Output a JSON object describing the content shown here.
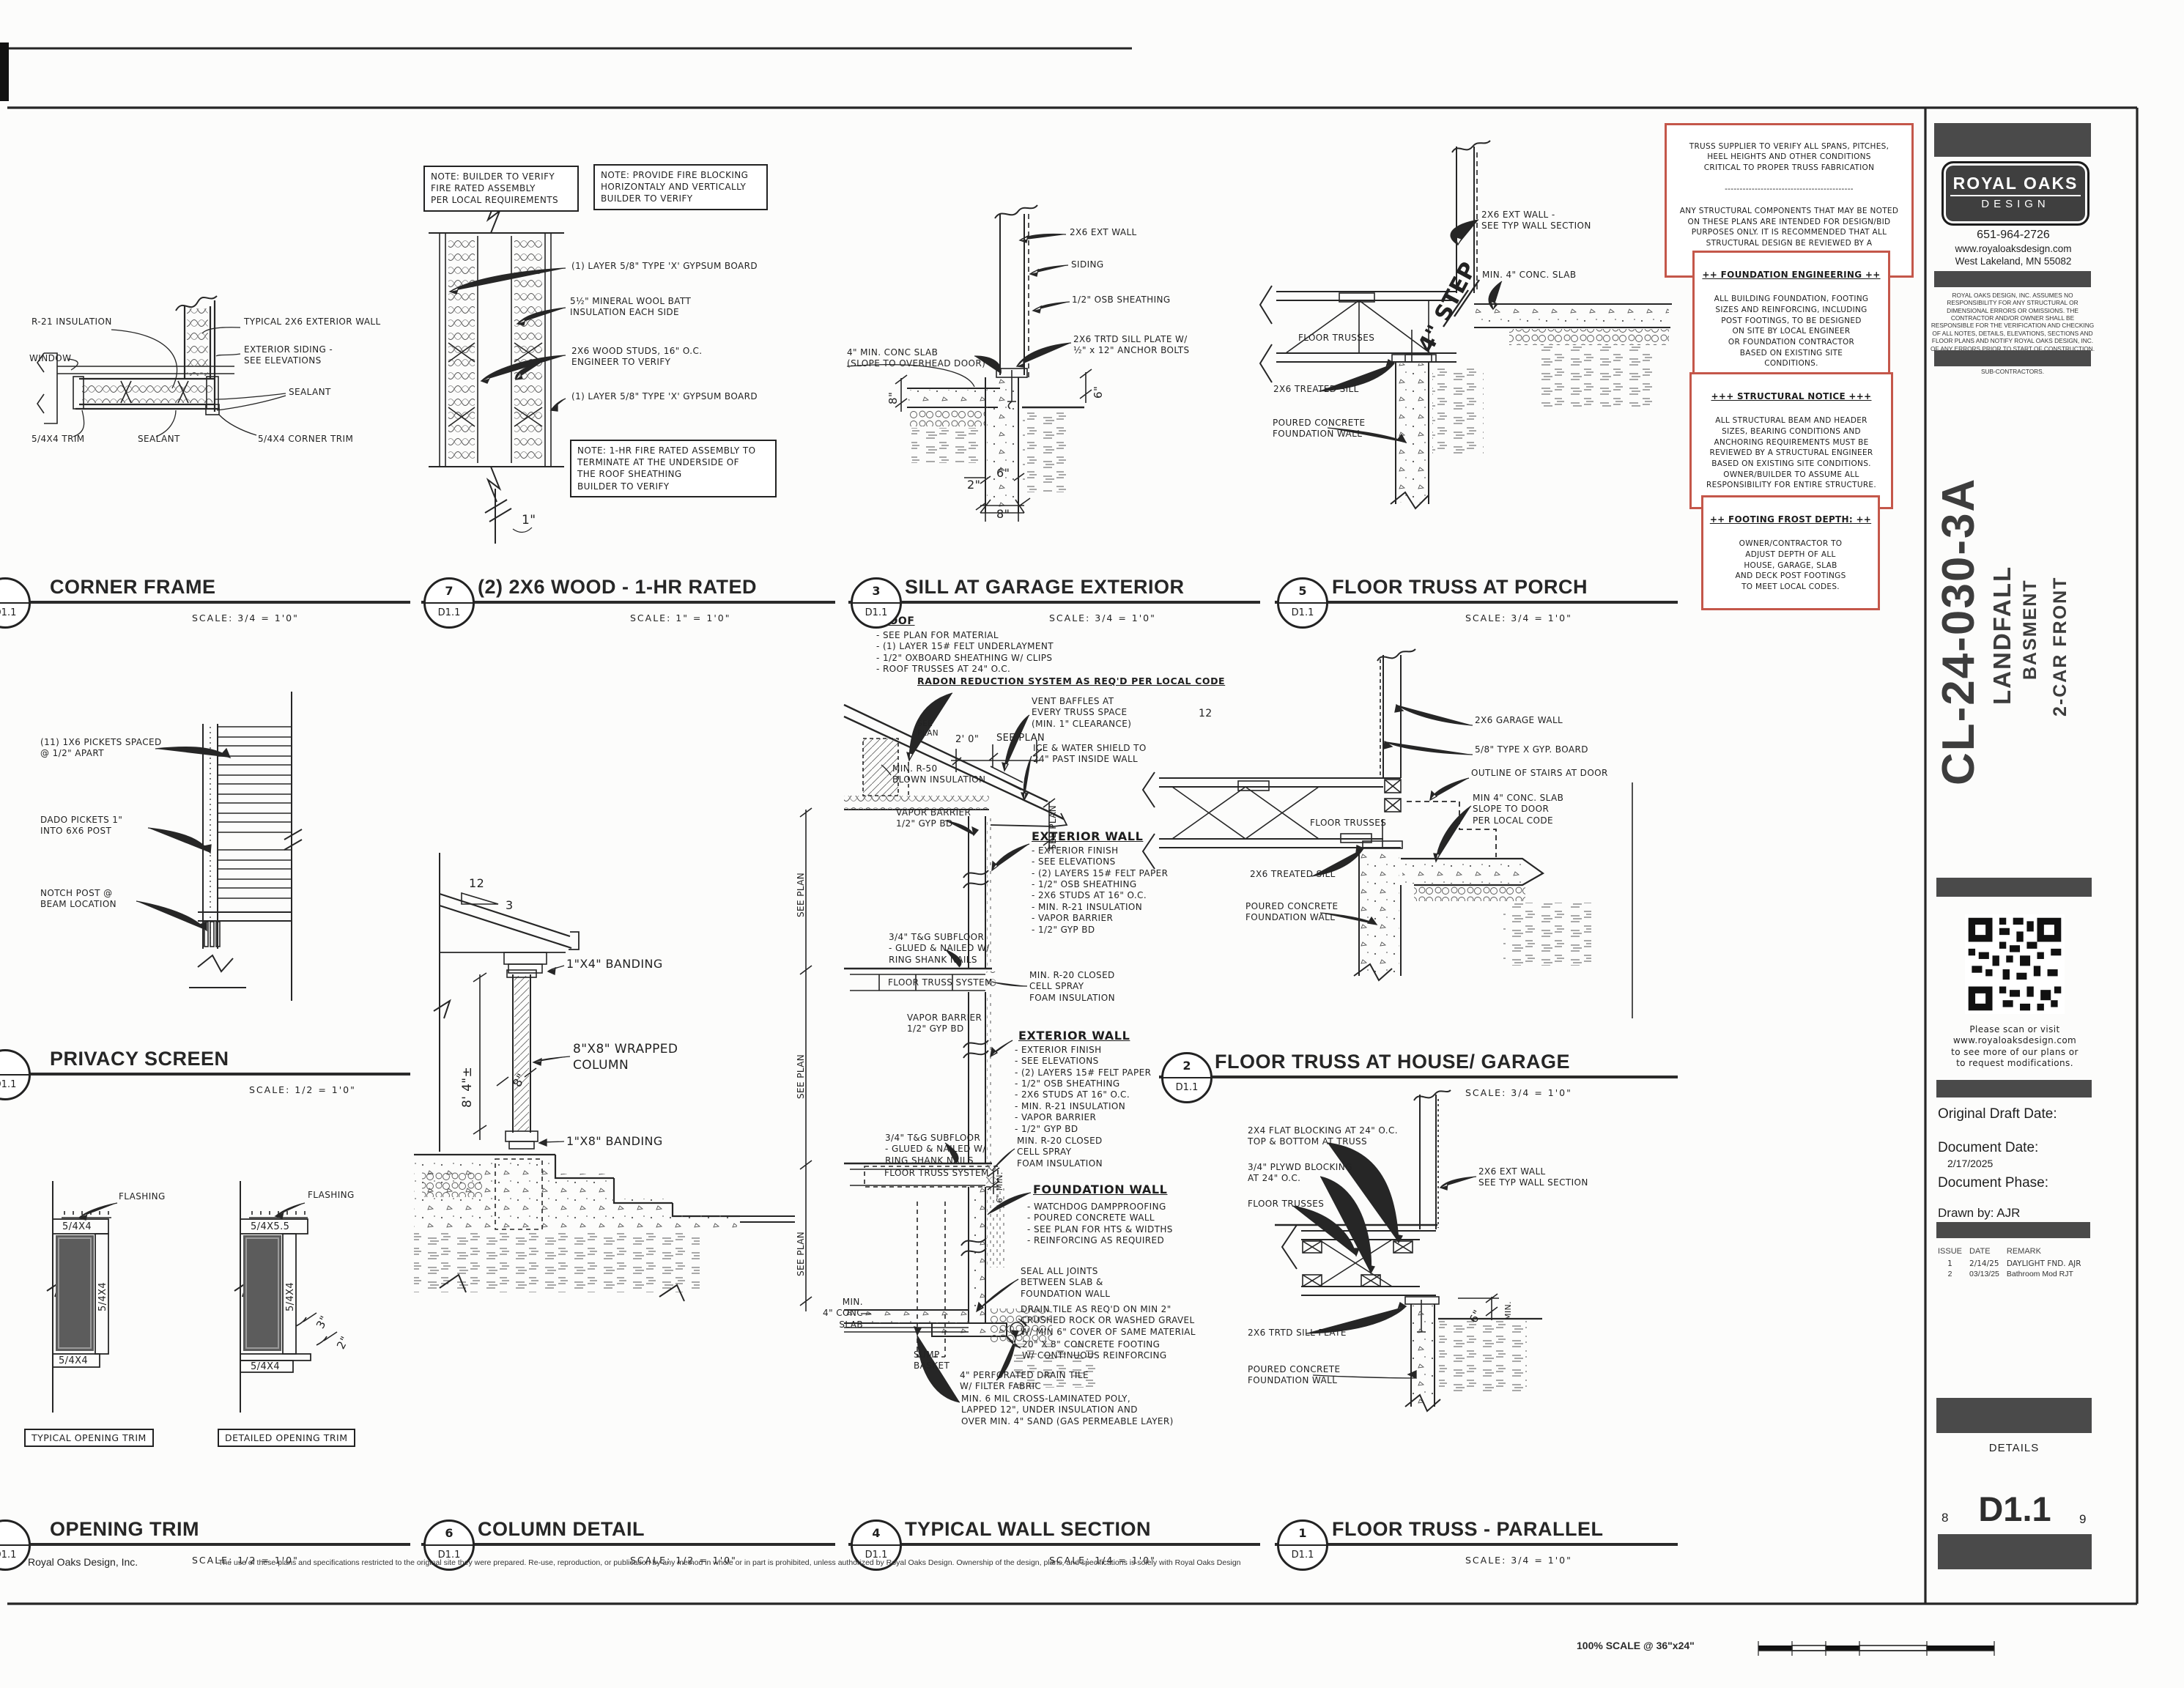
{
  "sheet": {
    "id": "CL-24-030-3A",
    "project": "LANDFALL",
    "variant": "BASMENT",
    "front": "2-CAR FRONT",
    "sheet_number": "D1.1",
    "sheet_title": "DETAILS",
    "page_left": "8",
    "page_right": "9",
    "scale_note": "100% SCALE @ 36\"x24\"",
    "firm": "Royal Oaks Design, Inc.",
    "copyright": "The use of these plans and specifications restricted to the original site they were prepared. Re-use, reproduction, or publication by any method in whole or in part is prohibited, unless authorized by Royal Oaks Design. Ownership of the design, plans, and specifications is solely with Royal Oaks Design"
  },
  "titleblock": {
    "logo_line1": "ROYAL OAKS",
    "logo_line2": "DESIGN",
    "phone": "651-964-2726",
    "website": "www.royaloaksdesign.com",
    "address": "West Lakeland, MN 55082",
    "disclaimer": "ROYAL OAKS DESIGN, INC. ASSUMES NO RESPONSIBILITY FOR ANY STRUCTURAL OR DIMENSIONAL ERRORS OR OMISSIONS. THE CONTRACTOR AND/OR OWNER SHALL BE RESPONSIBLE FOR THE VERIFICATION AND CHECKING OF ALL NOTES, DETAILS, ELEVATIONS, SECTIONS AND FLOOR PLANS AND NOTIFY ROYAL OAKS DESIGN, INC. OF ANY ERRORS PRIOR TO START OF CONSTRUCTION. ROYAL OAKS DESIGN, INC. ASSUMES NO RESPONSIBILITY FOR THE WORKMANSHIP OF THE SUB-CONTRACTORS.",
    "qr_caption": "Please scan or visit\nwww.royaloaksdesign.com\nto see more of our plans or\nto request modifications.",
    "original_draft_label": "Original Draft Date:",
    "document_date_label": "Document Date:",
    "document_date": "2/17/2025",
    "document_phase_label": "Document Phase:",
    "drawn_by": "Drawn by: AJR",
    "issue_table": {
      "headers": [
        "ISSUE",
        "DATE",
        "REMARK"
      ],
      "rows": [
        [
          "1",
          "2/14/25",
          "DAYLIGHT FND. AJR"
        ],
        [
          "2",
          "03/13/25",
          "Bathroom Mod RJT"
        ]
      ]
    }
  },
  "notices": {
    "truss_top": "TRUSS SUPPLIER TO VERIFY ALL SPANS, PITCHES,\nHEEL HEIGHTS AND OTHER CONDITIONS\nCRITICAL TO PROPER TRUSS FABRICATION",
    "truss_divider": "-------------------------------------------",
    "truss_bottom": "ANY STRUCTURAL COMPONENTS THAT MAY BE NOTED\nON THESE PLANS ARE INTENDED FOR DESIGN/BID\nPURPOSES ONLY. IT IS RECOMMENDED THAT ALL\nSTRUCTURAL DESIGN BE REVIEWED BY A\nLICENSED PROFESSIONAL ENGINEER",
    "foundation_title": "++ FOUNDATION ENGINEERING ++",
    "foundation_body": "ALL BUILDING FOUNDATION, FOOTING\nSIZES AND REINFORCING, INCLUDING\nPOST FOOTINGS, TO BE DESIGNED\nON SITE BY LOCAL ENGINEER\nOR FOUNDATION CONTRACTOR\nBASED ON EXISTING SITE\nCONDITIONS.",
    "structural_title": "+++ STRUCTURAL NOTICE +++",
    "structural_body": "ALL STRUCTURAL BEAM AND HEADER\nSIZES, BEARING CONDITIONS AND\nANCHORING REQUIREMENTS MUST BE\nREVIEWED BY A STRUCTURAL ENGINEER\nBASED ON EXISTING SITE CONDITIONS.\nOWNER/BUILDER TO ASSUME ALL\nRESPONSIBILITY FOR ENTIRE STRUCTURE.",
    "frost_title": "++ FOOTING FROST DEPTH: ++",
    "frost_body": "OWNER/CONTRACTOR TO\nADJUST DEPTH OF ALL\nHOUSE, GARAGE, SLAB\nAND DECK POST FOOTINGS\nTO MEET LOCAL CODES."
  },
  "details": {
    "corner_frame": {
      "badge_num": "",
      "badge_ref": "D1.1",
      "title": "CORNER FRAME",
      "scale": "SCALE: 3/4 = 1'0\"",
      "labels": {
        "r21": "R-21 INSULATION",
        "window": "WINDOW",
        "typ_wall": "TYPICAL 2X6 EXTERIOR WALL",
        "siding": "EXTERIOR SIDING -\nSEE ELEVATIONS",
        "sealant1": "SEALANT",
        "trim": "5/4X4 TRIM",
        "sealant2": "SEALANT",
        "corner_trim": "5/4X4 CORNER TRIM"
      }
    },
    "wood_1hr": {
      "badge_num": "7",
      "badge_ref": "D1.1",
      "title": "(2) 2X6 WOOD - 1-HR RATED",
      "scale": "SCALE: 1\" = 1'0\"",
      "labels": {
        "note1": "NOTE: BUILDER TO VERIFY\nFIRE RATED ASSEMBLY\nPER LOCAL REQUIREMENTS",
        "note2": "NOTE: PROVIDE FIRE BLOCKING\nHORIZONTALY AND VERTICALLY\nBUILDER TO VERIFY",
        "gypsum_top": "(1) LAYER 5/8\" TYPE 'X' GYPSUM BOARD",
        "mineral": "5½\" MINERAL WOOL BATT\nINSULATION EACH SIDE",
        "studs": "2X6 WOOD STUDS, 16\" O.C.\nENGINEER TO VERIFY",
        "gypsum_bottom": "(1) LAYER 5/8\" TYPE 'X' GYPSUM BOARD",
        "note3": "NOTE: 1-HR FIRE RATED ASSEMBLY TO\nTERMINATE AT THE UNDERSIDE OF\nTHE ROOF SHEATHING\nBUILDER TO VERIFY",
        "dim1": "1\""
      }
    },
    "sill_garage": {
      "badge_num": "3",
      "badge_ref": "D1.1",
      "title": "SILL AT GARAGE EXTERIOR",
      "scale": "SCALE: 3/4 = 1'0\"",
      "labels": {
        "ext_wall": "2X6 EXT WALL",
        "siding": "SIDING",
        "osb": "1/2\" OSB SHEATHING",
        "sill_plate": "2X6 TRTD SILL PLATE W/\n½\" x 12\" ANCHOR BOLTS",
        "slab": "4\" MIN. CONC SLAB\n(SLOPE TO OVERHEAD DOOR)",
        "dim8_left": "8\"",
        "dim6_right": "6\"",
        "dim2": "2\"",
        "dim6": "6\"",
        "dim8": "8\""
      }
    },
    "truss_porch": {
      "badge_num": "5",
      "badge_ref": "D1.1",
      "title": "FLOOR TRUSS AT PORCH",
      "scale": "SCALE: 3/4 = 1'0\"",
      "labels": {
        "step": "4\" STEP",
        "ext_wall": "2X6 EXT WALL -\nSEE TYP WALL SECTION",
        "slab": "MIN. 4\" CONC. SLAB",
        "trusses": "FLOOR TRUSSES",
        "sill": "2X6 TREATED SILL",
        "fnd": "POURED CONCRETE\nFOUNDATION WALL"
      }
    },
    "privacy_screen": {
      "badge_num": "",
      "badge_ref": "D1.1",
      "title": "PRIVACY SCREEN",
      "scale": "SCALE: 1/2 = 1'0\"",
      "labels": {
        "pickets": "(11) 1X6 PICKETS SPACED\n@ 1/2\" APART",
        "dado": "DADO PICKETS 1\"\nINTO 6X6 POST",
        "notch": "NOTCH POST @\nBEAM LOCATION"
      }
    },
    "column_detail": {
      "badge_num": "6",
      "badge_ref": "D1.1",
      "title": "COLUMN DETAIL",
      "scale": "SCALE: 1/2 = 1'0\"",
      "labels": {
        "slope_run": "12",
        "slope_rise": "3",
        "band_top": "1\"X4\" BANDING",
        "column": "8\"X8\" WRAPPED\nCOLUMN",
        "dim8": "8\"",
        "height": "8' 4\"±",
        "band_bottom": "1\"X8\" BANDING"
      }
    },
    "wall_section": {
      "badge_num": "4",
      "badge_ref": "D1.1",
      "title": "TYPICAL WALL SECTION",
      "scale": "SCALE: 1/4 = 1'0\"",
      "labels": {
        "roof_header": "ROOF",
        "roof_list": "- SEE PLAN FOR MATERIAL\n- (1) LAYER 15# FELT UNDERLAYMENT\n- 1/2\" OXBOARD SHEATHING W/ CLIPS\n- ROOF TRUSSES AT 24\" O.C.",
        "radon": "RADON REDUCTION SYSTEM\nAS REQ'D PER LOCAL CODE",
        "slope12": "12",
        "see_plan_slope": "SEE\nPLAN",
        "vent": "VENT BAFFLES AT\nEVERY TRUSS SPACE\n(MIN. 1\" CLEARANCE)",
        "dim20": "2' 0\"",
        "see_plan_h": "SEE PLAN",
        "ice": "ICE & WATER SHIELD TO\n24\" PAST INSIDE WALL",
        "blown": "MIN. R-50\nBLOWN INSULATION",
        "see_plan_v": "SEE PLAN",
        "vapor": "VAPOR BARRIER\n1/2\" GYP BD",
        "extwall_header": "EXTERIOR WALL",
        "extwall_list": "- EXTERIOR FINISH\n   - SEE ELEVATIONS\n- (2) LAYERS 15# FELT PAPER\n- 1/2\" OSB SHEATHING\n- 2X6 STUDS AT 16\" O.C.\n- MIN. R-21 INSULATION\n- VAPOR BARRIER\n- 1/2\" GYP BD",
        "subfloor": "3/4\" T&G SUBFLOOR\n- GLUED & NAILED W/\n  RING SHANK NAILS",
        "floor_truss": "FLOOR TRUSS SYSTEM",
        "spray": "MIN. R-20 CLOSED\nCELL SPRAY\nFOAM INSULATION",
        "fnd_header": "FOUNDATION WALL",
        "fnd_list": "- WATCHDOG DAMPPROOFING\n- POURED CONCRETE WALL\n   - SEE PLAN FOR HTS & WIDTHS\n   - REINFORCING AS REQUIRED",
        "min6": "6\" MIN.",
        "seal": "SEAL ALL JOINTS\nBETWEEN SLAB &\nFOUNDATION WALL",
        "drain_rock": "DRAIN TILE AS REQ'D ON MIN 2\"\nCRUSHED ROCK OR WASHED GRAVEL\nW/ MIN 6\" COVER OF SAME MATERIAL",
        "footing": "20\" X 8\" CONCRETE FOOTING\nW/ CONTINUOUS REINFORCING",
        "sump": "SUMP\nBASKET",
        "drain_tile": "4\" PERFORATED DRAIN TILE\nW/ FILTER FABRIC",
        "poly": "MIN. 6 MIL CROSS-LAMINATED POLY,\nLAPPED 12\", UNDER INSULATION AND\nOVER MIN. 4\" SAND (GAS PERMEABLE LAYER)",
        "conc_slab": "MIN.\n4\" CONC SLAB"
      }
    },
    "truss_house_garage": {
      "badge_num": "2",
      "badge_ref": "D1.1",
      "title": "FLOOR TRUSS AT HOUSE/ GARAGE",
      "scale": "SCALE: 3/4 = 1'0\"",
      "labels": {
        "garage_wall": "2X6 GARAGE WALL",
        "gyp": "5/8\" TYPE X GYP. BOARD",
        "stairs": "OUTLINE OF STAIRS AT DOOR",
        "slab": "MIN 4\" CONC. SLAB\nSLOPE TO DOOR\nPER LOCAL CODE",
        "trusses": "FLOOR TRUSSES",
        "sill": "2X6 TREATED SILL",
        "fnd": "POURED CONCRETE\nFOUNDATION WALL"
      }
    },
    "opening_trim": {
      "badge_num": "",
      "badge_ref": "D1.1",
      "title": "OPENING TRIM",
      "scale": "SCALE: 1/2 = 1'0\"",
      "labels": {
        "flashing": "FLASHING",
        "t54x4": "5/4X4",
        "t54x55": "5/4X5.5",
        "dim3": "3\"",
        "dim2": "2\"",
        "cap_typical": "TYPICAL OPENING TRIM",
        "cap_detailed": "DETAILED OPENING TRIM"
      }
    },
    "truss_parallel": {
      "badge_num": "1",
      "badge_ref": "D1.1",
      "title": "FLOOR TRUSS - PARALLEL",
      "scale": "SCALE: 3/4 = 1'0\"",
      "labels": {
        "blocking1": "2X4 FLAT BLOCKING AT 24\" O.C.\nTOP & BOTTOM AT TRUSS",
        "blocking2": "3/4\" PLYWD BLOCKING\nAT 24\" O.C.",
        "trusses": "FLOOR TRUSSES",
        "ext_wall": "2X6 EXT WALL\nSEE TYP WALL SECTION",
        "sill": "2X6 TRTD SILL PLATE",
        "fnd": "POURED CONCRETE\nFOUNDATION WALL",
        "dim6": "6\"",
        "min_label": "MIN."
      }
    }
  }
}
